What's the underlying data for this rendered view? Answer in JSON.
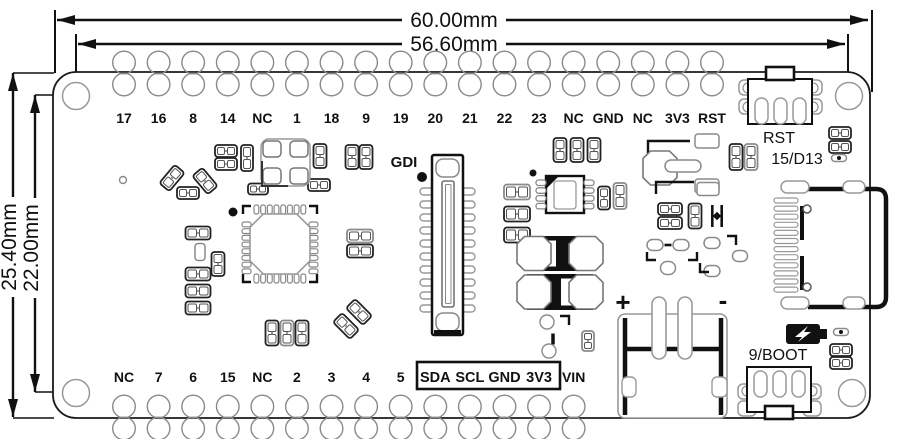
{
  "dimensions": {
    "width_outer": "60.00mm",
    "width_inner": "56.60mm",
    "height_outer": "25.40mm",
    "height_inner": "22.00mm"
  },
  "top_pins": [
    "17",
    "16",
    "8",
    "14",
    "NC",
    "1",
    "18",
    "9",
    "19",
    "20",
    "21",
    "22",
    "23",
    "NC",
    "GND",
    "NC",
    "3V3",
    "RST"
  ],
  "bottom_pins": [
    "NC",
    "7",
    "6",
    "15",
    "NC",
    "2",
    "3",
    "4",
    "5",
    "SDA",
    "SCL",
    "GND",
    "3V3",
    "VIN"
  ],
  "bottom_boxed_range": [
    9,
    12
  ],
  "labels": {
    "gdi": "GDI",
    "rst_button": "RST",
    "led": "15/D13",
    "boot_button": "9/BOOT",
    "battery_plus": "+",
    "battery_minus": "-"
  },
  "icons": {
    "charge": "battery-charge-icon"
  },
  "colors": {
    "line": "#111111",
    "silkscreen_grey": "#8a8a8a",
    "background": "#ffffff"
  },
  "pin_layout": {
    "first_x": 124,
    "spacing": 34.588,
    "top_edge_y": 72,
    "bottom_edge_y": 418
  },
  "parts": [
    {
      "t": "ring",
      "x": 123,
      "y": 180,
      "r": 3.5
    },
    {
      "t": "p2",
      "x": 172,
      "y": 178,
      "w": 24,
      "h": 13,
      "rot": -50,
      "tone": "dark"
    },
    {
      "t": "p2",
      "x": 188,
      "y": 193,
      "w": 22,
      "h": 12,
      "tone": "dark"
    },
    {
      "t": "p2",
      "x": 205,
      "y": 181,
      "w": 24,
      "h": 13,
      "rot": 50,
      "tone": "dark"
    },
    {
      "t": "p2",
      "x": 226,
      "y": 151,
      "w": 22,
      "h": 12,
      "tone": "dark"
    },
    {
      "t": "p2",
      "x": 226,
      "y": 164,
      "w": 22,
      "h": 12,
      "tone": "dark"
    },
    {
      "t": "p2",
      "x": 247,
      "y": 158,
      "w": 12,
      "h": 26,
      "vert": 1,
      "tone": "dark"
    },
    {
      "t": "p2",
      "x": 258,
      "y": 189,
      "w": 20,
      "h": 11,
      "tone": "dark"
    },
    {
      "t": "p2",
      "x": 320,
      "y": 156,
      "w": 13,
      "h": 24,
      "vert": 1,
      "tone": "dark"
    },
    {
      "t": "p2",
      "x": 352,
      "y": 157,
      "w": 13,
      "h": 24,
      "vert": 1,
      "tone": "dark"
    },
    {
      "t": "p2",
      "x": 366,
      "y": 157,
      "w": 13,
      "h": 24,
      "vert": 1,
      "tone": "dark"
    },
    {
      "t": "p2",
      "x": 319,
      "y": 185,
      "w": 22,
      "h": 12,
      "tone": "dark"
    },
    {
      "t": "p2",
      "x": 198,
      "y": 233,
      "w": 25,
      "h": 13,
      "tone": "dark"
    },
    {
      "t": "pad",
      "x": 200,
      "y": 252,
      "w": 10,
      "h": 17
    },
    {
      "t": "p2",
      "x": 218,
      "y": 264,
      "w": 13,
      "h": 24,
      "vert": 1,
      "tone": "dark"
    },
    {
      "t": "p2",
      "x": 198,
      "y": 274,
      "w": 25,
      "h": 13,
      "tone": "dark"
    },
    {
      "t": "p2",
      "x": 198,
      "y": 291,
      "w": 25,
      "h": 13,
      "tone": "dark"
    },
    {
      "t": "p2",
      "x": 198,
      "y": 308,
      "w": 25,
      "h": 13,
      "tone": "dark"
    },
    {
      "t": "p2",
      "x": 360,
      "y": 236,
      "w": 26,
      "h": 13,
      "tone": "grey"
    },
    {
      "t": "p2",
      "x": 360,
      "y": 251,
      "w": 26,
      "h": 13,
      "tone": "dark"
    },
    {
      "t": "p2",
      "x": 359,
      "y": 312,
      "w": 24,
      "h": 13,
      "rot": 45,
      "tone": "dark"
    },
    {
      "t": "p2",
      "x": 346,
      "y": 326,
      "w": 24,
      "h": 13,
      "rot": 45,
      "tone": "dark"
    },
    {
      "t": "p2",
      "x": 272,
      "y": 333,
      "w": 13,
      "h": 25,
      "vert": 1,
      "tone": "dark"
    },
    {
      "t": "p2",
      "x": 287,
      "y": 333,
      "w": 13,
      "h": 25,
      "vert": 1,
      "tone": "grey"
    },
    {
      "t": "p2",
      "x": 302,
      "y": 333,
      "w": 13,
      "h": 25,
      "vert": 1,
      "tone": "dark"
    },
    {
      "t": "p2",
      "x": 517,
      "y": 192,
      "w": 26,
      "h": 15,
      "tone": "grey"
    },
    {
      "t": "p2",
      "x": 517,
      "y": 214,
      "w": 26,
      "h": 15,
      "tone": "dark"
    },
    {
      "t": "p2",
      "x": 517,
      "y": 235,
      "w": 26,
      "h": 15,
      "tone": "dark"
    },
    {
      "t": "p2",
      "x": 560,
      "y": 150,
      "w": 13,
      "h": 24,
      "vert": 1,
      "tone": "dark"
    },
    {
      "t": "p2",
      "x": 577,
      "y": 150,
      "w": 13,
      "h": 24,
      "vert": 1,
      "tone": "dark"
    },
    {
      "t": "p2",
      "x": 594,
      "y": 150,
      "w": 13,
      "h": 24,
      "vert": 1,
      "tone": "dark"
    },
    {
      "t": "p2",
      "x": 604,
      "y": 198,
      "w": 12,
      "h": 23,
      "vert": 1,
      "tone": "dark"
    },
    {
      "t": "p2",
      "x": 620,
      "y": 196,
      "w": 13,
      "h": 26,
      "vert": 1,
      "tone": "grey"
    },
    {
      "t": "bracket",
      "pts": "648,163 648,141 690,141"
    },
    {
      "t": "oct",
      "x": 660,
      "y": 168,
      "r": 17
    },
    {
      "t": "stad",
      "x": 683,
      "y": 166,
      "w": 36,
      "h": 12
    },
    {
      "t": "pad",
      "x": 707,
      "y": 141,
      "w": 24,
      "h": 14
    },
    {
      "t": "pad",
      "x": 707,
      "y": 186,
      "w": 24,
      "h": 14
    },
    {
      "t": "p2",
      "x": 736,
      "y": 157,
      "w": 13,
      "h": 26,
      "vert": 1,
      "tone": "dark"
    },
    {
      "t": "p2",
      "x": 751,
      "y": 157,
      "w": 13,
      "h": 26,
      "vert": 1,
      "tone": "grey"
    },
    {
      "t": "bracket",
      "pts": "656,194 656,182 694,182"
    },
    {
      "t": "pad",
      "x": 708,
      "y": 189,
      "w": 22,
      "h": 13
    },
    {
      "t": "p2",
      "x": 670,
      "y": 209,
      "w": 24,
      "h": 12,
      "tone": "dark"
    },
    {
      "t": "p2",
      "x": 670,
      "y": 223,
      "w": 24,
      "h": 12,
      "tone": "dark"
    },
    {
      "t": "p2",
      "x": 695,
      "y": 216,
      "w": 13,
      "h": 25,
      "vert": 1,
      "tone": "dark"
    },
    {
      "t": "capsym",
      "x": 717,
      "y": 216
    },
    {
      "t": "stad",
      "x": 655,
      "y": 245,
      "w": 16,
      "h": 11
    },
    {
      "t": "stad",
      "x": 681,
      "y": 245,
      "w": 16,
      "h": 11
    },
    {
      "t": "bar",
      "x": 668,
      "y": 245,
      "w": 7,
      "h": 2.6
    },
    {
      "t": "bracket",
      "pts": "647,252 647,260 656,260"
    },
    {
      "t": "bracket",
      "pts": "688,260 697,260 697,252"
    },
    {
      "t": "stad",
      "x": 668,
      "y": 268,
      "w": 15,
      "h": 13
    },
    {
      "t": "stad",
      "x": 712,
      "y": 243,
      "w": 16,
      "h": 11
    },
    {
      "t": "bracket",
      "pts": "727,236 736,236 736,245"
    },
    {
      "t": "stad",
      "x": 740,
      "y": 256,
      "w": 15,
      "h": 11
    },
    {
      "t": "stad",
      "x": 712,
      "y": 271,
      "w": 16,
      "h": 11
    },
    {
      "t": "bracket",
      "pts": "700,263 700,272 709,272"
    },
    {
      "t": "ring",
      "x": 547,
      "y": 322,
      "r": 7
    },
    {
      "t": "bracket",
      "pts": "560,316 569,316 569,325"
    },
    {
      "t": "bar",
      "x": 553,
      "y": 339,
      "w": 3.5,
      "h": 11
    },
    {
      "t": "ring",
      "x": 549,
      "y": 351,
      "r": 7
    },
    {
      "t": "p2",
      "x": 588,
      "y": 341,
      "w": 12,
      "h": 20,
      "vert": 1,
      "tone": "grey"
    },
    {
      "t": "p2",
      "x": 840,
      "y": 133,
      "w": 22,
      "h": 12,
      "tone": "dark"
    },
    {
      "t": "p2",
      "x": 840,
      "y": 147,
      "w": 22,
      "h": 12,
      "tone": "dark"
    },
    {
      "t": "stad",
      "x": 839,
      "y": 158,
      "w": 15,
      "h": 7
    },
    {
      "t": "dot",
      "x": 839,
      "y": 158,
      "r": 2
    },
    {
      "t": "p2",
      "x": 841,
      "y": 350,
      "w": 22,
      "h": 12,
      "tone": "dark"
    },
    {
      "t": "p2",
      "x": 841,
      "y": 363,
      "w": 22,
      "h": 12,
      "tone": "dark"
    },
    {
      "t": "stad",
      "x": 841,
      "y": 332,
      "w": 15,
      "h": 7
    },
    {
      "t": "dot",
      "x": 841,
      "y": 332,
      "r": 2
    },
    {
      "t": "tant",
      "x": 527,
      "y": 236,
      "w": 66,
      "h": 35,
      "bx": 556
    },
    {
      "t": "tant",
      "x": 527,
      "y": 274,
      "w": 66,
      "h": 36,
      "bx": 546
    },
    {
      "t": "dot",
      "x": 233,
      "y": 212,
      "r": 4.5
    },
    {
      "t": "dot",
      "x": 422,
      "y": 177,
      "r": 5
    },
    {
      "t": "dot",
      "x": 533,
      "y": 173,
      "r": 3.5
    }
  ]
}
